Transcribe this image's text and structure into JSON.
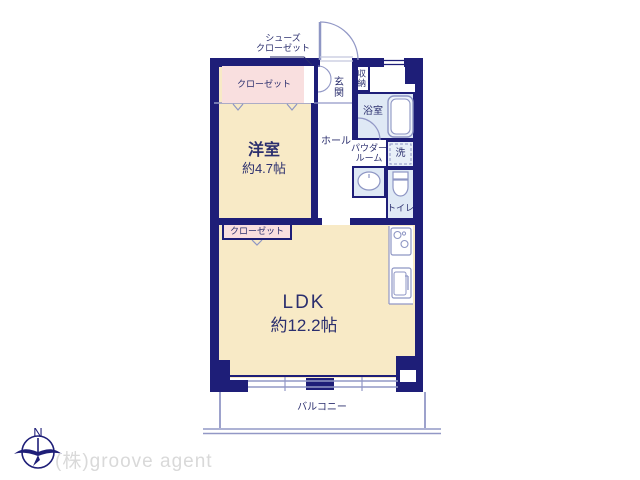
{
  "plan": {
    "rooms": {
      "western_room": {
        "name": "洋室",
        "size": "約4.7帖"
      },
      "ldk": {
        "name": "LDK",
        "size": "約12.2帖"
      },
      "hall": {
        "name": "ホール"
      },
      "entrance": {
        "name": "玄関"
      },
      "storage": {
        "name": "収納"
      },
      "bathroom": {
        "name": "浴室"
      },
      "powder_room": {
        "line1": "パウダー",
        "line2": "ルーム"
      },
      "laundry": {
        "name": "洗"
      },
      "toilet": {
        "name": "トイレ"
      },
      "balcony": {
        "name": "バルコニー"
      },
      "closet_bedroom": {
        "name": "クローゼット"
      },
      "closet_ldk": {
        "name": "クローゼット"
      },
      "shoes_closet": {
        "line1": "シューズ",
        "line2": "クローゼット"
      }
    },
    "compass": {
      "north_label": "N"
    },
    "footer": {
      "company_name": "(株)groove agent"
    },
    "icons": [
      "compass-north-icon",
      "bathtub-icon",
      "toilet-bowl-icon",
      "washbasin-icon",
      "stove-icon",
      "kitchen-sink-icon",
      "entrance-door-arc-icon",
      "bathroom-door-arc-icon"
    ],
    "colors": {
      "wall": "#1e1e78",
      "room_fill": "#f8eac6",
      "closet_fill": "#f9dfdf",
      "wet_fill": "#dfe9f5",
      "thin_line": "#9298c6",
      "label_text": "#2b2f6e",
      "company_text": "#d9d9d9"
    }
  }
}
